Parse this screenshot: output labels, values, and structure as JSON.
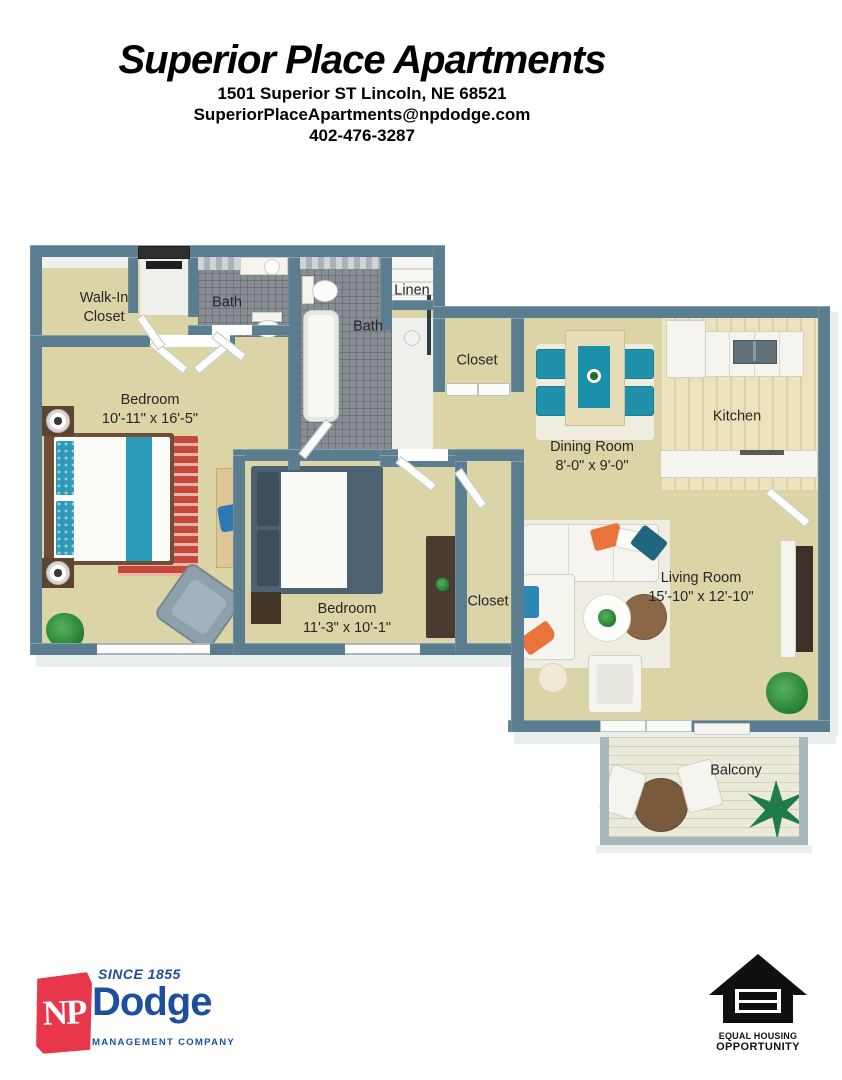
{
  "header": {
    "title": "Superior Place Apartments",
    "address": "1501 Superior ST Lincoln, NE 68521",
    "email": "SuperiorPlaceApartments@npdodge.com",
    "phone": "402-476-3287"
  },
  "plan": {
    "rooms": {
      "walk_in_closet": {
        "line1": "Walk-In",
        "line2": "Closet"
      },
      "bath_1": {
        "label": "Bath"
      },
      "bath_2": {
        "label": "Bath"
      },
      "linen": {
        "label": "Linen"
      },
      "hall_closet": {
        "label": "Closet"
      },
      "bedroom_1": {
        "label": "Bedroom",
        "dims": "10'-11\" x 16'-5\""
      },
      "dining_room": {
        "label": "Dining Room",
        "dims": "8'-0\" x 9'-0\""
      },
      "kitchen": {
        "label": "Kitchen"
      },
      "bedroom_2": {
        "label": "Bedroom",
        "dims": "11'-3\" x 10'-1\""
      },
      "bedroom_2_closet": {
        "label": "Closet"
      },
      "living_room": {
        "label": "Living Room",
        "dims": "15'-10\" x 12'-10\""
      },
      "balcony": {
        "label": "Balcony"
      }
    },
    "colors": {
      "wall": "#5a7d8f",
      "floor_tan": "#dbd4a6",
      "tile_gray": "#868d93",
      "accent_teal": "#2193ad",
      "accent_red": "#c6483a",
      "accent_orange": "#e8743c"
    }
  },
  "footer": {
    "np_dodge": {
      "since": "SINCE 1855",
      "initials": "NP",
      "name": "Dodge",
      "tagline": "MANAGEMENT COMPANY"
    },
    "equal_housing": {
      "line1": "EQUAL HOUSING",
      "line2": "OPPORTUNITY"
    }
  }
}
